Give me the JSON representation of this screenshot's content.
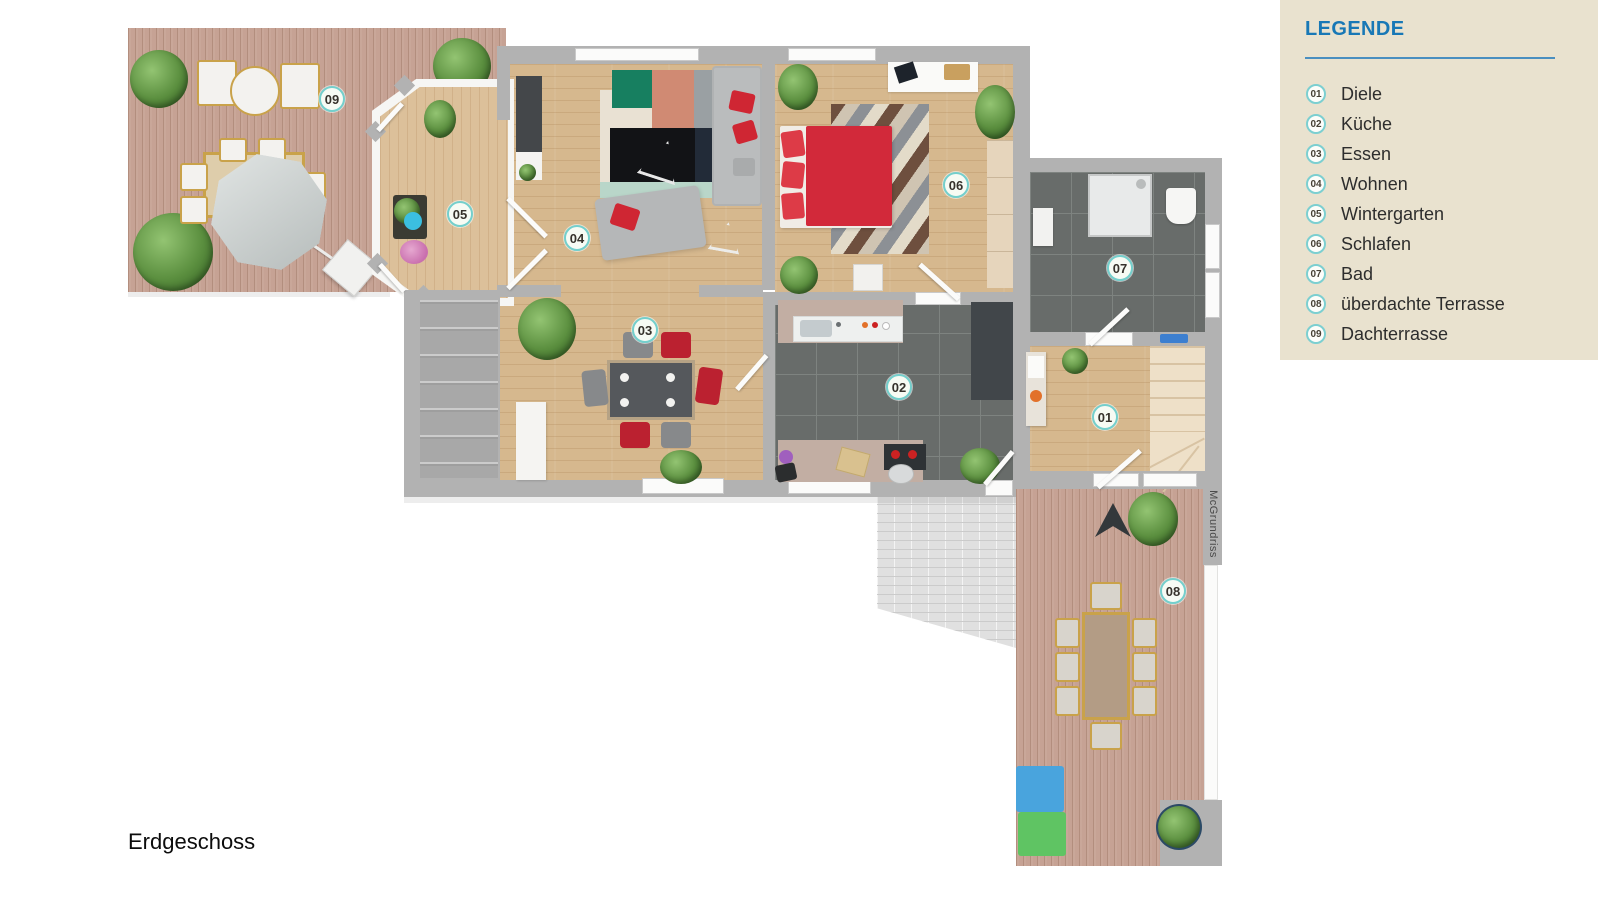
{
  "floor_label": "Erdgeschoss",
  "watermark": "McGrundriss",
  "legend": {
    "title": "LEGENDE",
    "items": [
      {
        "number": "01",
        "label": "Diele"
      },
      {
        "number": "02",
        "label": "Küche"
      },
      {
        "number": "03",
        "label": "Essen"
      },
      {
        "number": "04",
        "label": "Wohnen"
      },
      {
        "number": "05",
        "label": "Wintergarten"
      },
      {
        "number": "06",
        "label": "Schlafen"
      },
      {
        "number": "07",
        "label": "Bad"
      },
      {
        "number": "08",
        "label": "überdachte Terrasse"
      },
      {
        "number": "09",
        "label": "Dachterrasse"
      }
    ]
  },
  "colors": {
    "legend_background": "#e9e2cf",
    "legend_title_blue": "#1878b6",
    "legend_divider_blue": "#4a8fc0",
    "badge_ring_teal": "#74cfcc",
    "wall_gray": "#b2b2b2",
    "room_wood": "#d6b88e",
    "deck_wood": "#c6a294",
    "tile_dark": "#686c6a",
    "bed_red": "#d2293a",
    "chair_red": "#bb2130",
    "sofa_gray": "#b9babb",
    "box_blue": "#49a4dd",
    "box_green": "#5fc463"
  }
}
